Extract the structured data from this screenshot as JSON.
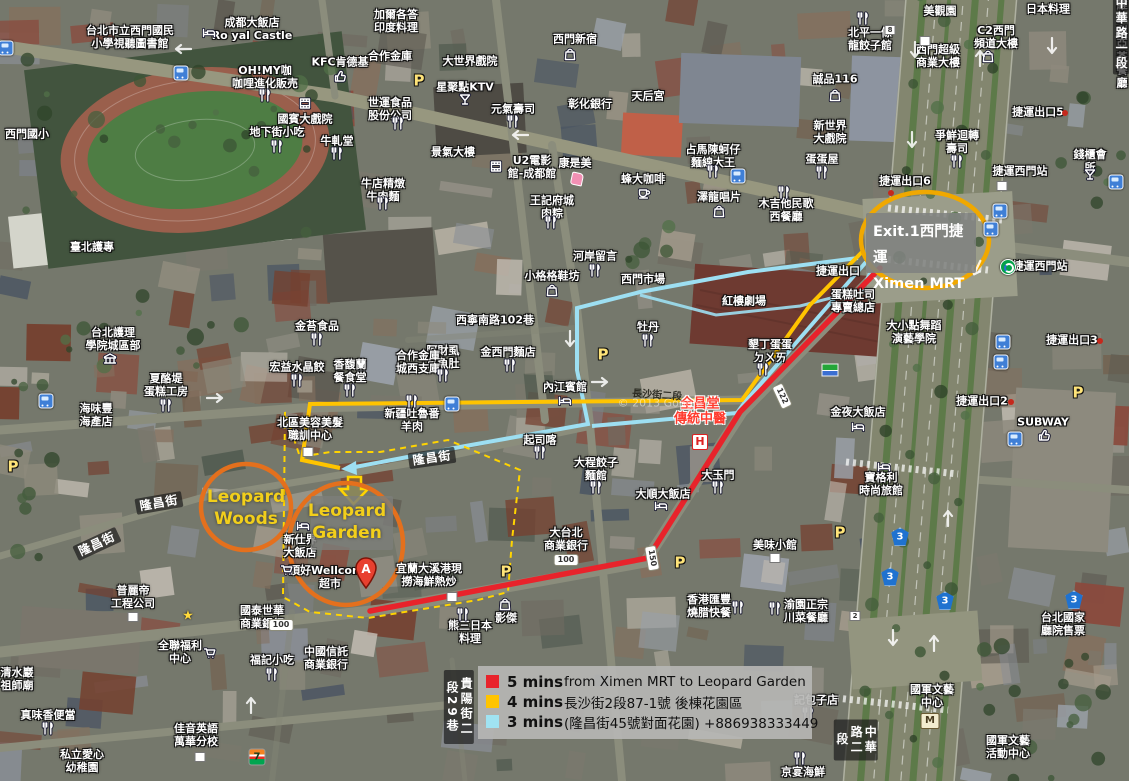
{
  "map": {
    "watermark": "© 2013 Google",
    "colors": {
      "route_red": "#e8232b",
      "route_yellow": "#ffc400",
      "route_blue": "#9ddff2",
      "mrt_ellipse": "#f0a800",
      "leopard_ellipse": "#e4701d",
      "garden_dash": "#ffd400"
    },
    "legend": {
      "rows": [
        {
          "color": "#e8232b",
          "time": "5 mins",
          "desc": "from Ximen MRT to Leopard Garden"
        },
        {
          "color": "#ffc400",
          "time": "4 mins",
          "desc": "長沙街2段87-1號 後棟花園區"
        },
        {
          "color": "#a0e3f2",
          "time": "3 mins",
          "desc": "(隆昌街45號對面花園) +886938333449"
        }
      ]
    },
    "callouts": {
      "mrt": {
        "text": "Exit.1西門捷運\nXimen MRT"
      },
      "woods": {
        "text": "Leopard\nWoods"
      },
      "garden": {
        "text": "Leopard\nGarden"
      },
      "marker": "A"
    },
    "labels": [
      {
        "t": "台北市立西門國民\n小學視聽圖書館",
        "x": 130,
        "y": 38
      },
      {
        "t": "成都大飯店\nRo yal Castle",
        "x": 252,
        "y": 30
      },
      {
        "t": "加爾各答\n印度料理",
        "x": 396,
        "y": 22
      },
      {
        "t": "合作金庫",
        "x": 390,
        "y": 57
      },
      {
        "t": "大世界戲院",
        "x": 470,
        "y": 62
      },
      {
        "t": "星聚點KTV",
        "x": 465,
        "y": 88
      },
      {
        "t": "世運食品\n股份公司",
        "x": 390,
        "y": 110
      },
      {
        "t": "元氣壽司",
        "x": 513,
        "y": 110
      },
      {
        "t": "西門新宿",
        "x": 575,
        "y": 40
      },
      {
        "t": "彰化銀行",
        "x": 590,
        "y": 105
      },
      {
        "t": "天后宮",
        "x": 648,
        "y": 97
      },
      {
        "t": "美觀園",
        "x": 940,
        "y": 12
      },
      {
        "t": "日本料理",
        "x": 1048,
        "y": 10
      },
      {
        "t": "OH!MY咖\n咖哩進化販売",
        "x": 265,
        "y": 78
      },
      {
        "t": "KFC肯德基",
        "x": 340,
        "y": 63
      },
      {
        "t": "國賓大戲院",
        "x": 305,
        "y": 120
      },
      {
        "t": "地下街小吃",
        "x": 277,
        "y": 133
      },
      {
        "t": "牛軋堂",
        "x": 337,
        "y": 142
      },
      {
        "t": "西門國小",
        "x": 27,
        "y": 135
      },
      {
        "t": "臺北護專",
        "x": 92,
        "y": 248
      },
      {
        "t": "誠品116",
        "x": 835,
        "y": 80
      },
      {
        "t": "北平一條\n龍餃子館",
        "x": 870,
        "y": 40
      },
      {
        "t": "西門超級\n商業大樓",
        "x": 938,
        "y": 57
      },
      {
        "t": "C2西門\n頻道大樓",
        "x": 996,
        "y": 38
      },
      {
        "t": "維多利亞\n茶餐廳",
        "x": 1122,
        "y": 45
      },
      {
        "t": "新世界\n大戲院",
        "x": 830,
        "y": 133
      },
      {
        "t": "蛋蛋屋",
        "x": 822,
        "y": 160
      },
      {
        "t": "爭鮮迴轉\n壽司",
        "x": 957,
        "y": 143
      },
      {
        "t": "捷運出口5",
        "x": 1038,
        "y": 113
      },
      {
        "t": "捷運出口6",
        "x": 905,
        "y": 182
      },
      {
        "t": "錢櫃會所",
        "x": 1090,
        "y": 162
      },
      {
        "t": "捷運西門站",
        "x": 1020,
        "y": 172
      },
      {
        "t": "捷運西門站",
        "x": 1040,
        "y": 267
      },
      {
        "t": "U2電影\n館-成都館",
        "x": 532,
        "y": 168
      },
      {
        "t": "康是美",
        "x": 575,
        "y": 164
      },
      {
        "t": "蜂大咖啡",
        "x": 643,
        "y": 180
      },
      {
        "t": "王記府城\n肉粽",
        "x": 552,
        "y": 208
      },
      {
        "t": "澤龍唱片",
        "x": 719,
        "y": 198
      },
      {
        "t": "木吉他民歌\n西餐廳",
        "x": 786,
        "y": 211
      },
      {
        "t": "捷運出口",
        "x": 838,
        "y": 272
      },
      {
        "t": "河岸留言",
        "x": 595,
        "y": 257
      },
      {
        "t": "小格格鞋坊",
        "x": 552,
        "y": 277
      },
      {
        "t": "西門市場",
        "x": 643,
        "y": 280
      },
      {
        "t": "紅樓劇場",
        "x": 744,
        "y": 302
      },
      {
        "t": "西寧南路102巷",
        "x": 495,
        "y": 321
      },
      {
        "t": "牡丹",
        "x": 648,
        "y": 328
      },
      {
        "t": "阿財虱\n目魚肚",
        "x": 443,
        "y": 358
      },
      {
        "t": "金西門麵店",
        "x": 508,
        "y": 353
      },
      {
        "t": "合作金庫\n城西支庫",
        "x": 418,
        "y": 363
      },
      {
        "t": "宏益水晶餃",
        "x": 297,
        "y": 368
      },
      {
        "t": "香馥蘭\n餐食堂",
        "x": 350,
        "y": 372
      },
      {
        "t": "金苔食品",
        "x": 317,
        "y": 327
      },
      {
        "t": "台北護理\n學院城區部",
        "x": 113,
        "y": 340
      },
      {
        "t": "夏酪堤\n蛋糕工房",
        "x": 166,
        "y": 386
      },
      {
        "t": "海味豐\n海產店",
        "x": 96,
        "y": 416
      },
      {
        "t": "新疆吐魯番\n羊肉",
        "x": 412,
        "y": 421
      },
      {
        "t": "起司喀",
        "x": 540,
        "y": 441
      },
      {
        "t": "內江賓館",
        "x": 565,
        "y": 388
      },
      {
        "t": "北區美容美髮\n職訓中心",
        "x": 310,
        "y": 430
      },
      {
        "t": "墾丁蛋蛋\nㄉㄨㄞ",
        "x": 770,
        "y": 352
      },
      {
        "t": "蛋糕吐司\n專賣總店",
        "x": 853,
        "y": 302
      },
      {
        "t": "大小點舞蹈\n演藝學院",
        "x": 914,
        "y": 333
      },
      {
        "t": "金夜大飯店",
        "x": 858,
        "y": 413
      },
      {
        "t": "寶格利\n時尚旅館",
        "x": 881,
        "y": 485
      },
      {
        "t": "大順大飯店",
        "x": 663,
        "y": 495
      },
      {
        "t": "大玉門",
        "x": 718,
        "y": 476
      },
      {
        "t": "大程餃子\n麵館",
        "x": 596,
        "y": 470
      },
      {
        "t": "大台北\n商業銀行",
        "x": 566,
        "y": 540
      },
      {
        "t": "美味小館",
        "x": 775,
        "y": 546
      },
      {
        "t": "香港匯豐\n燒腊快餐",
        "x": 709,
        "y": 607
      },
      {
        "t": "渝園正宗\n川菜餐廳",
        "x": 806,
        "y": 612
      },
      {
        "t": "記包子店",
        "x": 816,
        "y": 701
      },
      {
        "t": "京宴海鮮",
        "x": 803,
        "y": 773
      },
      {
        "t": "國軍文藝\n中心",
        "x": 932,
        "y": 697
      },
      {
        "t": "國軍文藝\n活動中心",
        "x": 1008,
        "y": 748
      },
      {
        "t": "台北國家\n廳院售票",
        "x": 1063,
        "y": 625
      },
      {
        "t": "SUBWAY",
        "x": 1043,
        "y": 423
      },
      {
        "t": "捷運出口2",
        "x": 982,
        "y": 402
      },
      {
        "t": "捷運出口3",
        "x": 1072,
        "y": 341
      },
      {
        "t": "頂好Wellcome\n超市",
        "x": 330,
        "y": 578
      },
      {
        "t": "新仕界\n大飯店",
        "x": 300,
        "y": 547
      },
      {
        "t": "宜蘭大溪港現\n撈海鮮熱炒",
        "x": 429,
        "y": 576
      },
      {
        "t": "中國信託\n商業銀行",
        "x": 326,
        "y": 659
      },
      {
        "t": "熊三日本\n料理",
        "x": 470,
        "y": 633
      },
      {
        "t": "影傑",
        "x": 506,
        "y": 619
      },
      {
        "t": "國泰世華\n商業銀行",
        "x": 262,
        "y": 618
      },
      {
        "t": "全聯福利\n中心",
        "x": 180,
        "y": 653
      },
      {
        "t": "福記小吃",
        "x": 272,
        "y": 661
      },
      {
        "t": "真味香便當",
        "x": 48,
        "y": 716
      },
      {
        "t": "私立愛心\n幼稚園",
        "x": 82,
        "y": 762
      },
      {
        "t": "佳音英語\n萬華分校",
        "x": 196,
        "y": 736
      },
      {
        "t": "清水巖\n祖師廟",
        "x": 17,
        "y": 680
      },
      {
        "t": "普麗帝\n工程公司",
        "x": 133,
        "y": 598
      },
      {
        "t": "牛店精燉\n牛肉麵",
        "x": 383,
        "y": 191
      },
      {
        "t": "占馬陳蚵仔\n麵線大王",
        "x": 713,
        "y": 157
      },
      {
        "t": "景氣大樓",
        "x": 453,
        "y": 153
      },
      {
        "t": "全昌堂\n傳統中醫",
        "x": 700,
        "y": 412,
        "k": "red"
      },
      {
        "t": "隆昌街",
        "x": 432,
        "y": 458,
        "k": "street",
        "r": -8
      },
      {
        "t": "隆昌街",
        "x": 159,
        "y": 503,
        "k": "street",
        "r": -10
      },
      {
        "t": "隆昌街",
        "x": 97,
        "y": 544,
        "k": "street",
        "r": -25
      },
      {
        "t": "貴陽街二段29巷",
        "x": 459,
        "y": 707,
        "k": "vstreet"
      },
      {
        "t": "中華路二段",
        "x": 856,
        "y": 740,
        "k": "vstreet"
      },
      {
        "t": "中華路一段",
        "x": 1121,
        "y": 34,
        "k": "vstreet"
      },
      {
        "t": "長沙街二段",
        "x": 657,
        "y": 396,
        "k": "road",
        "r": 4
      },
      {
        "t": "© 2013 Google",
        "x": 660,
        "y": 404,
        "k": "wm"
      }
    ],
    "icons": [
      {
        "k": "restaurant",
        "x": 265,
        "y": 97
      },
      {
        "k": "restaurant",
        "x": 513,
        "y": 123
      },
      {
        "k": "restaurant",
        "x": 277,
        "y": 148
      },
      {
        "k": "restaurant",
        "x": 337,
        "y": 155
      },
      {
        "k": "restaurant",
        "x": 398,
        "y": 125
      },
      {
        "k": "restaurant",
        "x": 863,
        "y": 20
      },
      {
        "k": "restaurant",
        "x": 957,
        "y": 163
      },
      {
        "k": "restaurant",
        "x": 822,
        "y": 174
      },
      {
        "k": "restaurant",
        "x": 595,
        "y": 272
      },
      {
        "k": "restaurant",
        "x": 648,
        "y": 342
      },
      {
        "k": "restaurant",
        "x": 443,
        "y": 377
      },
      {
        "k": "restaurant",
        "x": 510,
        "y": 367
      },
      {
        "k": "restaurant",
        "x": 297,
        "y": 382
      },
      {
        "k": "restaurant",
        "x": 350,
        "y": 392
      },
      {
        "k": "restaurant",
        "x": 317,
        "y": 341
      },
      {
        "k": "restaurant",
        "x": 166,
        "y": 407
      },
      {
        "k": "restaurant",
        "x": 412,
        "y": 403
      },
      {
        "k": "restaurant",
        "x": 540,
        "y": 454
      },
      {
        "k": "restaurant",
        "x": 784,
        "y": 194
      },
      {
        "k": "restaurant",
        "x": 551,
        "y": 224
      },
      {
        "k": "restaurant",
        "x": 713,
        "y": 173
      },
      {
        "k": "restaurant",
        "x": 763,
        "y": 371
      },
      {
        "k": "restaurant",
        "x": 738,
        "y": 609
      },
      {
        "k": "restaurant",
        "x": 775,
        "y": 610
      },
      {
        "k": "restaurant",
        "x": 808,
        "y": 715
      },
      {
        "k": "restaurant",
        "x": 800,
        "y": 760
      },
      {
        "k": "restaurant",
        "x": 463,
        "y": 616
      },
      {
        "k": "restaurant",
        "x": 272,
        "y": 676
      },
      {
        "k": "restaurant",
        "x": 48,
        "y": 730
      },
      {
        "k": "restaurant",
        "x": 596,
        "y": 489
      },
      {
        "k": "restaurant",
        "x": 718,
        "y": 489
      },
      {
        "k": "restaurant",
        "x": 383,
        "y": 205
      },
      {
        "k": "hotel",
        "x": 209,
        "y": 34
      },
      {
        "k": "hotel",
        "x": 565,
        "y": 402
      },
      {
        "k": "hotel",
        "x": 858,
        "y": 428
      },
      {
        "k": "hotel",
        "x": 884,
        "y": 468
      },
      {
        "k": "hotel",
        "x": 661,
        "y": 507
      },
      {
        "k": "hotel",
        "x": 303,
        "y": 527
      },
      {
        "k": "bag",
        "x": 570,
        "y": 56
      },
      {
        "k": "bag",
        "x": 835,
        "y": 97
      },
      {
        "k": "bag",
        "x": 988,
        "y": 58
      },
      {
        "k": "bag",
        "x": 552,
        "y": 292
      },
      {
        "k": "bag",
        "x": 719,
        "y": 213
      },
      {
        "k": "bag",
        "x": 505,
        "y": 606
      },
      {
        "k": "cart",
        "x": 287,
        "y": 572
      },
      {
        "k": "cart",
        "x": 210,
        "y": 655
      },
      {
        "k": "cafe",
        "x": 644,
        "y": 194
      },
      {
        "k": "movie",
        "x": 305,
        "y": 105
      },
      {
        "k": "movie",
        "x": 496,
        "y": 168
      },
      {
        "k": "martini",
        "x": 465,
        "y": 101
      },
      {
        "k": "martini",
        "x": 1090,
        "y": 176
      },
      {
        "k": "school",
        "x": 110,
        "y": 361
      },
      {
        "k": "thumb",
        "x": 340,
        "y": 78
      },
      {
        "k": "thumb",
        "x": 1044,
        "y": 437
      },
      {
        "k": "cosmetic",
        "x": 577,
        "y": 179
      },
      {
        "k": "mrt",
        "x": 1008,
        "y": 267
      },
      {
        "k": "flag",
        "x": 830,
        "y": 370
      },
      {
        "k": "bus",
        "x": 181,
        "y": 73
      },
      {
        "k": "bus",
        "x": 6,
        "y": 48
      },
      {
        "k": "bus",
        "x": 738,
        "y": 176
      },
      {
        "k": "bus",
        "x": 1116,
        "y": 182
      },
      {
        "k": "bus",
        "x": 1000,
        "y": 211
      },
      {
        "k": "bus",
        "x": 991,
        "y": 229
      },
      {
        "k": "bus",
        "x": 1003,
        "y": 342
      },
      {
        "k": "bus",
        "x": 1001,
        "y": 362
      },
      {
        "k": "bus",
        "x": 1015,
        "y": 439
      },
      {
        "k": "bus",
        "x": 452,
        "y": 404
      },
      {
        "k": "bus",
        "x": 46,
        "y": 401
      },
      {
        "k": "p",
        "x": 419,
        "y": 81
      },
      {
        "k": "p",
        "x": 603,
        "y": 355
      },
      {
        "k": "p",
        "x": 13,
        "y": 467
      },
      {
        "k": "p",
        "x": 1078,
        "y": 393
      },
      {
        "k": "p",
        "x": 840,
        "y": 533
      },
      {
        "k": "p",
        "x": 506,
        "y": 572
      },
      {
        "k": "p",
        "x": 680,
        "y": 563
      },
      {
        "k": "star",
        "x": 188,
        "y": 616
      },
      {
        "k": "h",
        "x": 700,
        "y": 442
      },
      {
        "k": "m",
        "x": 930,
        "y": 721
      },
      {
        "k": "seven",
        "x": 257,
        "y": 757
      },
      {
        "k": "shield",
        "ch": "122",
        "x": 782,
        "y": 396,
        "r": 65
      },
      {
        "k": "shield",
        "ch": "150",
        "x": 652,
        "y": 558,
        "r": 80
      },
      {
        "k": "shield",
        "ch": "100",
        "x": 566,
        "y": 560
      },
      {
        "k": "shield",
        "ch": "100",
        "x": 281,
        "y": 625
      },
      {
        "k": "shield3",
        "ch": "3",
        "x": 900,
        "y": 537
      },
      {
        "k": "shield3",
        "ch": "3",
        "x": 890,
        "y": 577
      },
      {
        "k": "shield3",
        "ch": "3",
        "x": 945,
        "y": 601
      },
      {
        "k": "shield3",
        "ch": "3",
        "x": 1074,
        "y": 600
      },
      {
        "k": "rdot",
        "x": 1065,
        "y": 113
      },
      {
        "k": "rdot",
        "x": 891,
        "y": 193
      },
      {
        "k": "rdot",
        "x": 1011,
        "y": 402
      },
      {
        "k": "rdot",
        "x": 1100,
        "y": 341
      },
      {
        "k": "wsq",
        "ch": "",
        "x": 1002,
        "y": 186
      },
      {
        "k": "wsq",
        "ch": "",
        "x": 308,
        "y": 452
      },
      {
        "k": "wsq",
        "ch": "",
        "x": 133,
        "y": 617
      },
      {
        "k": "wsq",
        "ch": "",
        "x": 775,
        "y": 558
      },
      {
        "k": "wsq",
        "ch": "",
        "x": 452,
        "y": 597
      },
      {
        "k": "wsq",
        "ch": "",
        "x": 200,
        "y": 757
      },
      {
        "k": "wsq",
        "ch": "2",
        "x": 855,
        "y": 616
      },
      {
        "k": "wsq",
        "ch": "8",
        "x": 890,
        "y": 30
      },
      {
        "k": "wsq",
        "ch": "",
        "x": 925,
        "y": 41
      },
      {
        "k": "arrow",
        "x": 915,
        "y": 52,
        "r": 180
      },
      {
        "k": "arrow",
        "x": 980,
        "y": 60,
        "r": 0
      },
      {
        "k": "arrow",
        "x": 1052,
        "y": 48,
        "r": 180
      },
      {
        "k": "arrow",
        "x": 912,
        "y": 142,
        "r": 180
      },
      {
        "k": "arrow",
        "x": 977,
        "y": 270,
        "r": 205
      },
      {
        "k": "arrow",
        "x": 948,
        "y": 520,
        "r": 0
      },
      {
        "k": "arrow",
        "x": 893,
        "y": 640,
        "r": 180
      },
      {
        "k": "arrow",
        "x": 934,
        "y": 645,
        "r": 0
      },
      {
        "k": "arrow",
        "x": 183,
        "y": 51,
        "r": 270
      },
      {
        "k": "arrow",
        "x": 520,
        "y": 137,
        "r": 270
      },
      {
        "k": "arrow",
        "x": 215,
        "y": 400,
        "r": 90
      },
      {
        "k": "arrow",
        "x": 600,
        "y": 384,
        "r": 90
      },
      {
        "k": "arrow",
        "x": 570,
        "y": 341,
        "r": 180
      },
      {
        "k": "arrow",
        "x": 251,
        "y": 707,
        "r": 0
      }
    ]
  }
}
